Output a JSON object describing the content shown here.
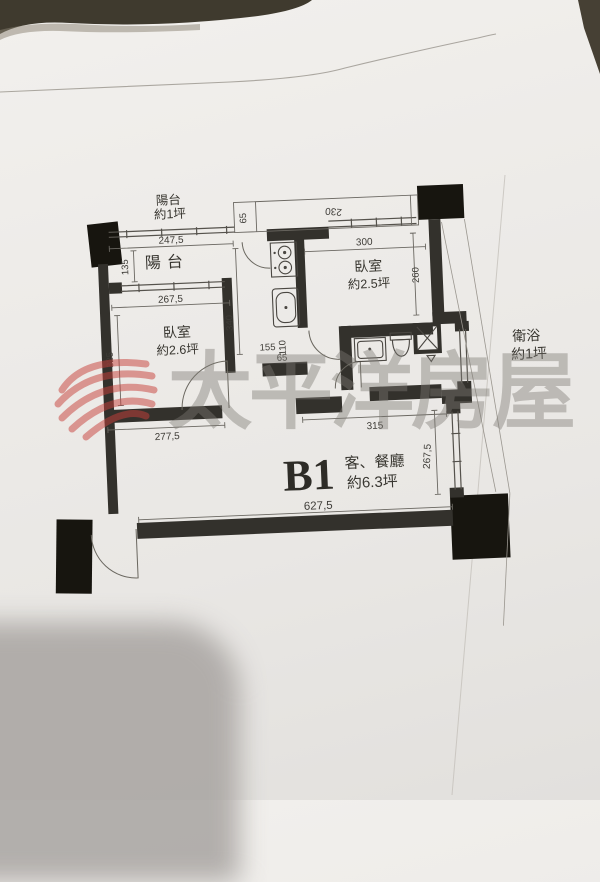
{
  "unit": {
    "id": "B1"
  },
  "rooms": {
    "balcony_note": {
      "name": "陽台",
      "area": "約1坪"
    },
    "balcony": {
      "name": "陽台"
    },
    "bedroom1": {
      "name": "臥室",
      "area": "約2.6坪"
    },
    "bedroom2": {
      "name": "臥室",
      "area": "約2.5坪"
    },
    "bathroom": {
      "name": "衛浴",
      "area": "約1坪"
    },
    "living": {
      "unit": "B1",
      "name": "客、餐廳",
      "area": "約6.3坪"
    }
  },
  "dims": {
    "balcony_width": "247,5",
    "balcony_depth": "135",
    "bedroom1_window": "267,5",
    "bedroom1_depth": "325",
    "bedroom1_width": "277,5",
    "kitchen_depth": "340",
    "corridor_width": "155",
    "kitchen_width": "110",
    "kitchen_stub": "65",
    "ledge_width": "230",
    "ledge_depth": "65",
    "bedroom2_width": "300",
    "bedroom2_depth": "260",
    "hall_width": "315",
    "living_width": "627,5",
    "living_depth": "267,5"
  },
  "watermark": {
    "text": "太平洋房屋",
    "logo": "pacific-swirl-ball-logo",
    "logo_color": "#c8403a",
    "text_color": "#7d7a74"
  }
}
